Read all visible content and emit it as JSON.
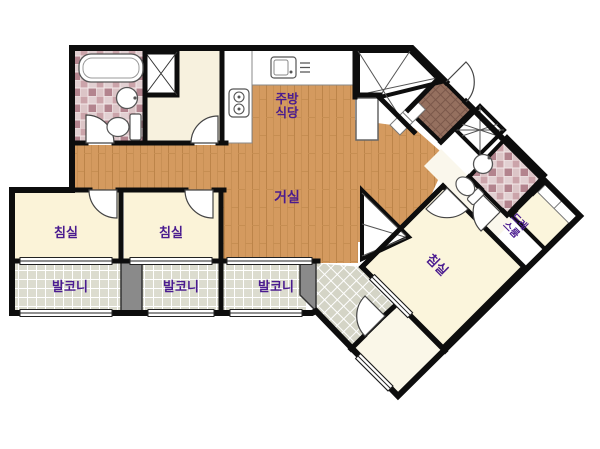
{
  "title": "apartment-floor-plan",
  "colors": {
    "wall": "#0d0d0d",
    "label_purple": "#4a1b8f",
    "wood_base": "#d49a5f",
    "room_cream": "#fbf3d8",
    "room_cream_light": "#faf7e8",
    "bath_tile_pink": "#cba4aa",
    "entry_tile_brown": "#95705f",
    "balcony_gray": "#dcdccf",
    "divider_gray": "#8a8a8a"
  },
  "labels": {
    "kitchen_line1": "주방",
    "kitchen_line2": "식당",
    "living": "거실",
    "bedroom1": "침실",
    "bedroom2": "침실",
    "bedroom3": "침실",
    "balcony1": "발코니",
    "balcony2": "발코니",
    "balcony3": "발코니",
    "dressroom_line1": "드레",
    "dressroom_line2": "스룸"
  }
}
